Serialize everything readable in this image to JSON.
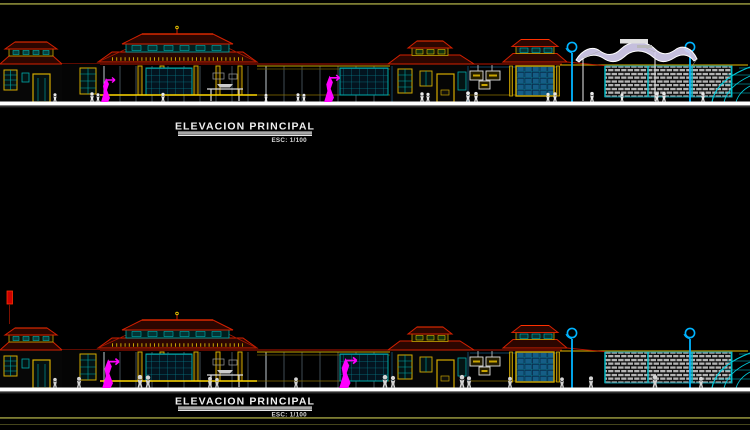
{
  "sheet": {
    "background": "#000000",
    "border_line_color": "#7d7d33"
  },
  "drawings": [
    {
      "title": "ELEVACION PRINCIPAL",
      "scale_label": "ESC: 1/100"
    },
    {
      "title": "ELEVACION PRINCIPAL",
      "scale_label": "ESC: 1/100"
    }
  ],
  "palette": {
    "roof_red": "#d42000",
    "roof_fill": "#2c0600",
    "frame_yellow": "#d4aa00",
    "beam_yellow": "#c8a400",
    "glass_teal": "#00aaaa",
    "lamp_cyan": "#00b4ff",
    "dome_cyan": "#00c8d8",
    "tree_magenta": "#ff00ff",
    "people_white": "#e9e9e9",
    "ground_white": "#ffffff",
    "brick_gray": "#b4b4b4",
    "canopy_lavender": "#d6cff0",
    "flag_red": "#cc0000"
  }
}
